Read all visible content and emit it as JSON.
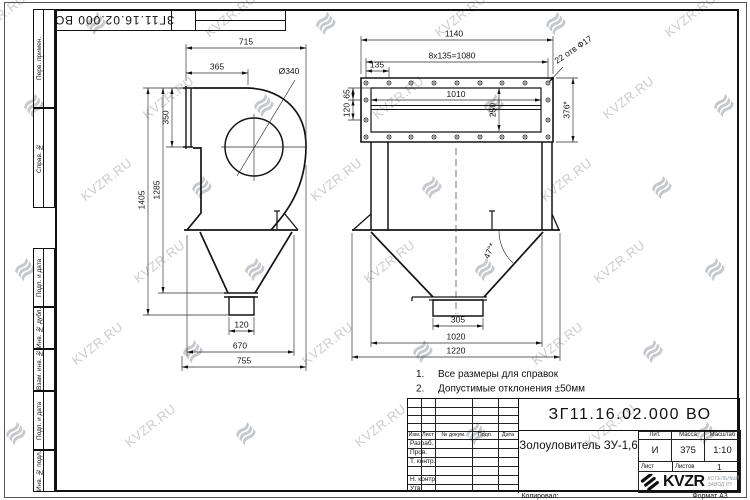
{
  "sheet": {
    "copied_label": "Копировал:",
    "format_label": "Формат А3"
  },
  "watermark": {
    "text": "KVZR.RU",
    "glyph": "≋",
    "color": "#b7bcc1"
  },
  "corner_stamp": {
    "number": "ЗГ11.16.02.000 ВО"
  },
  "margin_labels": [
    "Перв. примен.",
    "Справ. №",
    "Подп. и дата",
    "Инв. № дубл.",
    "Взам. инв. №",
    "Подп. и дата",
    "Инв. № подл."
  ],
  "views": {
    "side": {
      "dims": {
        "w715": "715",
        "w365": "365",
        "dia": "Ø340",
        "h350": "350",
        "h1285": "1285",
        "h1405": "1405",
        "w120": "120",
        "w670": "670",
        "w755": "755"
      }
    },
    "front": {
      "dims": {
        "w1140": "1140",
        "pitch": "8x135=1080",
        "w135": "135",
        "w1010": "1010",
        "h250": "250",
        "h65": "65",
        "h120": "120",
        "h376": "376*",
        "holes": "22 отв Ф17",
        "angle": "47°*",
        "w305": "305",
        "w1020": "1020",
        "w1220": "1220"
      }
    }
  },
  "notes": [
    {
      "num": "1.",
      "text": "Все размеры для справок"
    },
    {
      "num": "2.",
      "text": "Допустимые отклонения ±50мм"
    }
  ],
  "title_block": {
    "doc_number": "ЗГ11.16.02.000 ВО",
    "name": "Золоуловитель ЗУ-1,6",
    "lit_label": "Лит.",
    "lit_value": "И",
    "mass_label": "Масса",
    "mass_value": "375",
    "scale_label": "Масштаб",
    "scale_value": "1:10",
    "sheet_label": "Лист",
    "sheets_label": "Листов",
    "sheets_value": "1",
    "header": {
      "izm": "Изм.",
      "list": "Лист",
      "doc": "№ докум.",
      "sign": "Подп.",
      "date": "Дата"
    },
    "rows": {
      "razrab": "Разраб.",
      "prov": "Пров.",
      "tkontr": "Т. контр.",
      "nkontr": "Н. контр.",
      "utv": "Утв."
    },
    "logo": {
      "text": "KVZR",
      "sub1": "КОТЕЛЬНЫЙ",
      "sub2": "ЗАВОД.РУ"
    }
  }
}
